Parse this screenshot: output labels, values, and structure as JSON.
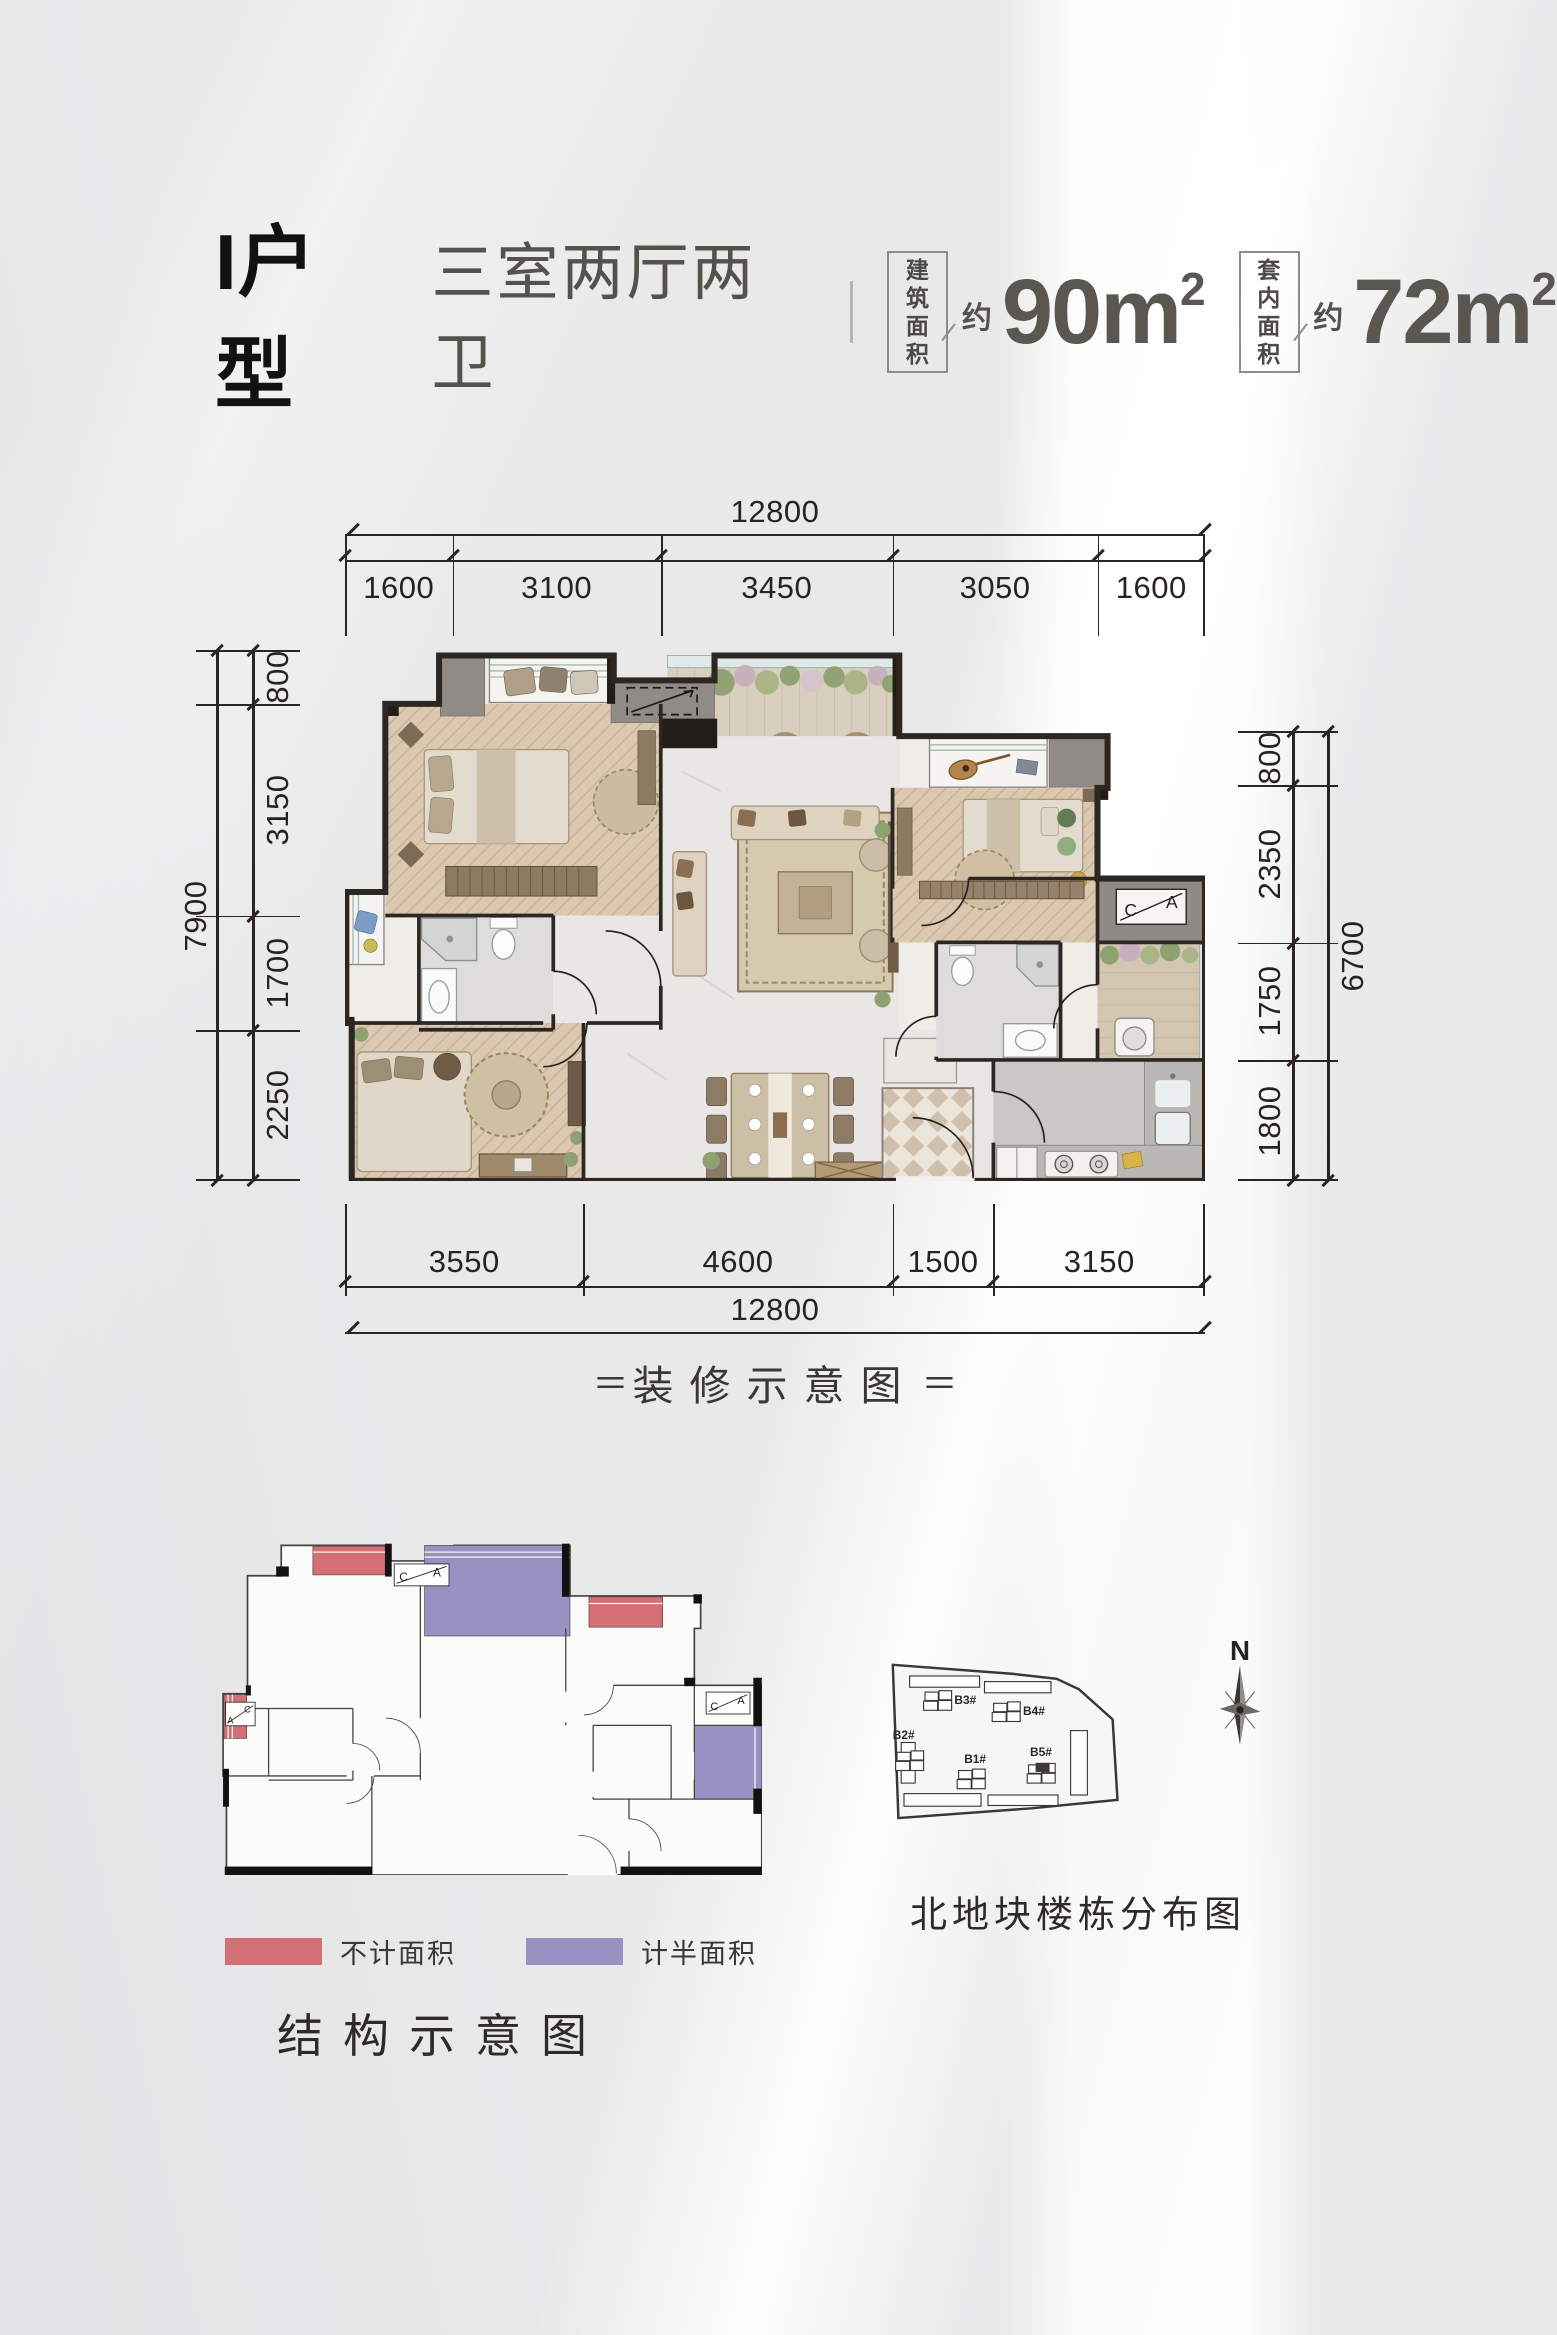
{
  "header": {
    "unit_name": "I户型",
    "layout_desc": "三室两厅两卫",
    "areas": [
      {
        "box_top": "建筑",
        "box_bottom": "面积",
        "approx": "约",
        "value": "90m",
        "sup": "2"
      },
      {
        "box_top": "套内",
        "box_bottom": "面积",
        "approx": "约",
        "value": "72m",
        "sup": "2"
      }
    ]
  },
  "plan": {
    "dims": {
      "top_total": "12800",
      "top_segments": [
        "1600",
        "3100",
        "3450",
        "3050",
        "1600"
      ],
      "left_total": "7900",
      "left_segments": [
        "800",
        "3150",
        "1700",
        "2250"
      ],
      "right_total": "6700",
      "right_segments": [
        "800",
        "2350",
        "1750",
        "1800"
      ],
      "bottom_segments": [
        "3550",
        "4600",
        "1500",
        "3150"
      ],
      "bottom_total": "12800"
    },
    "caption": "装修示意图",
    "caption_decor": "＝",
    "window_mark": {
      "c": "C",
      "a": "A"
    }
  },
  "structure": {
    "caption": "结构示意图",
    "legend": [
      {
        "label": "不计面积",
        "color": "#d56f76"
      },
      {
        "label": "计半面积",
        "color": "#9a91c3"
      }
    ]
  },
  "siteplan": {
    "caption": "北地块楼栋分布图",
    "compass_label": "N",
    "buildings": [
      "B1#",
      "B2#",
      "B3#",
      "B4#",
      "B5#"
    ]
  }
}
